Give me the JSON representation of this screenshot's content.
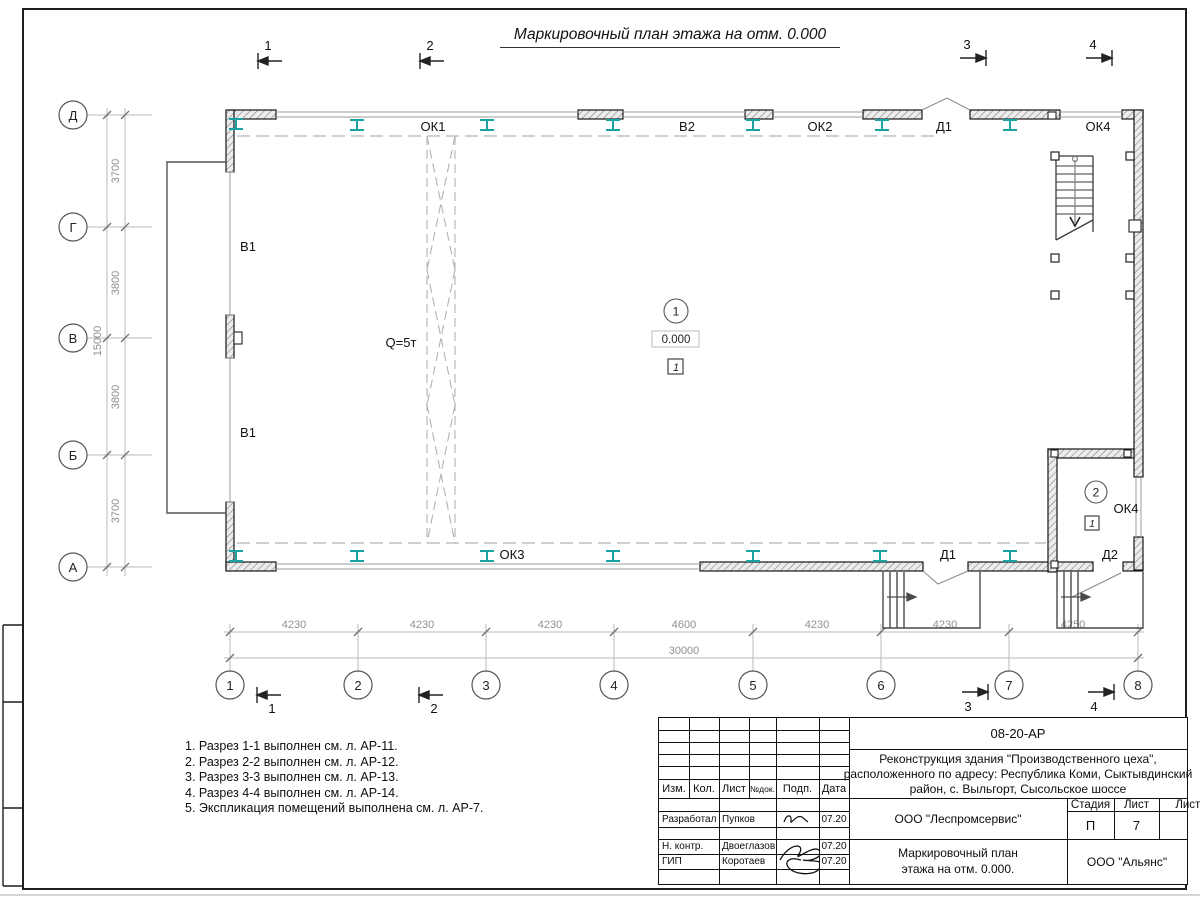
{
  "sheet": {
    "title": "Маркировочный план этажа на отм. 0.000"
  },
  "plan": {
    "axes_rows": [
      "Д",
      "Г",
      "В",
      "Б",
      "А"
    ],
    "axes_cols": [
      "1",
      "2",
      "3",
      "4",
      "5",
      "6",
      "7",
      "8"
    ],
    "dim_v_segments": [
      "3700",
      "3800",
      "3800",
      "3700"
    ],
    "dim_v_total": "15000",
    "dim_h_segments": [
      "4230",
      "4230",
      "4230",
      "4600",
      "4230",
      "4230",
      "4250"
    ],
    "dim_h_total": "30000",
    "sections": {
      "s1": "1",
      "s2": "2",
      "s3": "3",
      "s4": "4"
    },
    "marks": {
      "ok1": "ОК1",
      "v2": "В2",
      "ok2": "ОК2",
      "d1_top": "Д1",
      "ok4_top": "ОК4",
      "v1_upper": "В1",
      "v1_lower": "В1",
      "crane": "Q=5т",
      "ok3": "ОК3",
      "d1_bottom": "Д1",
      "d2": "Д2"
    },
    "room1": {
      "number": "1",
      "elevation": "0.000",
      "floor_type": "1"
    },
    "room2": {
      "number": "2",
      "window": "ОК4",
      "floor_type": "1"
    }
  },
  "notes": [
    "1. Разрез 1-1 выполнен см. л. АР-11.",
    "2. Разрез 2-2 выполнен см. л. АР-12.",
    "3. Разрез 3-3 выполнен см. л. АР-13.",
    "4. Разрез 4-4 выполнен см. л. АР-14.",
    "5. Экспликация помещений выполнена см. л. АР-7."
  ],
  "titleblock": {
    "doc_code": "08-20-АР",
    "project_line1": "Реконструкция здания \"Производственного цеха\",",
    "project_line2": "расположенного по адресу: Республика Коми, Сыктывдинский",
    "project_line3": "район, с. Выльгорт, Сысольское шоссе",
    "cols": {
      "izm": "Изм.",
      "kol": "Кол.",
      "list": "Лист",
      "ndok": "№док.",
      "podp": "Подп.",
      "data": "Дата"
    },
    "rows": [
      {
        "role": "Разработал",
        "name": "Пупков",
        "date": "07.20"
      },
      {
        "role": "Н. контр.",
        "name": "Двоеглазов",
        "date": "07.20"
      },
      {
        "role": "ГИП",
        "name": "Коротаев",
        "date": "07.20"
      }
    ],
    "org": "ООО \"Леспромсервис\"",
    "stage_label": "Стадия",
    "sheet_label": "Лист",
    "sheets_label": "Листов",
    "stage_value": "П",
    "sheet_value": "7",
    "title_line1": "Маркировочный план",
    "title_line2": "этажа на отм. 0.000.",
    "client": "ООО \"Альянс\""
  },
  "colors": {
    "steel_column": "#18a2a2",
    "dim": "#8f8f8f",
    "line": "#1a1a1a"
  }
}
